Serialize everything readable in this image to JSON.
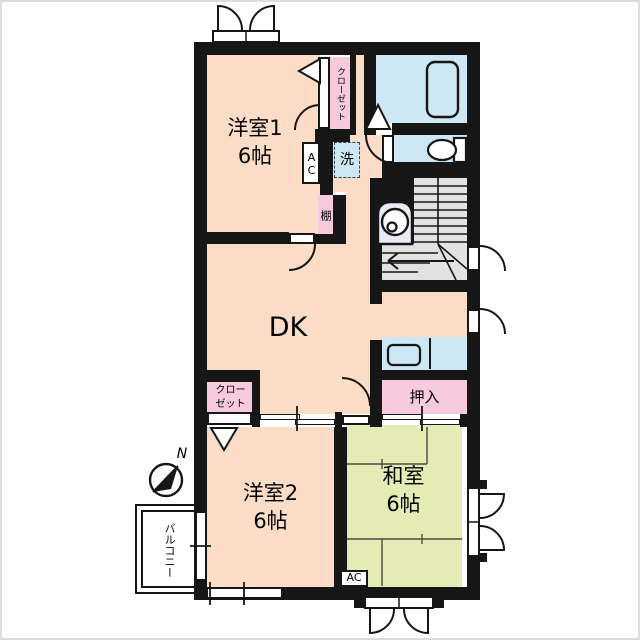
{
  "rooms": {
    "western1": {
      "label": "洋室1",
      "size": "6帖"
    },
    "dk": {
      "label": "DK"
    },
    "western2": {
      "label": "洋室2",
      "size": "6帖"
    },
    "japanese": {
      "label": "和室",
      "size": "6帖"
    }
  },
  "features": {
    "closet1": "クローゼット",
    "closet2_line1": "クロー",
    "closet2_line2": "ゼット",
    "oshiire": "押入",
    "shelf": "棚",
    "laundry": "洗",
    "ac_west1": "AC",
    "ac_japanese": "AC",
    "balcony": "バルコニー",
    "north": "N"
  },
  "icons": {
    "compass": "north-arrow",
    "bathtub": "bathtub",
    "toilet": "toilet",
    "sink": "kitchen-sink",
    "water_heater": "water-heater",
    "stairs": "staircase"
  },
  "colors": {
    "wall": "#161616",
    "room_peach": "#fbdcc6",
    "closet_pink": "#f8cadd",
    "wet_blue": "#cde7f5",
    "tatami_green": "#e4ebb4",
    "stairs_gray": "#e2e2e2",
    "equipment": "#eceaf6"
  }
}
